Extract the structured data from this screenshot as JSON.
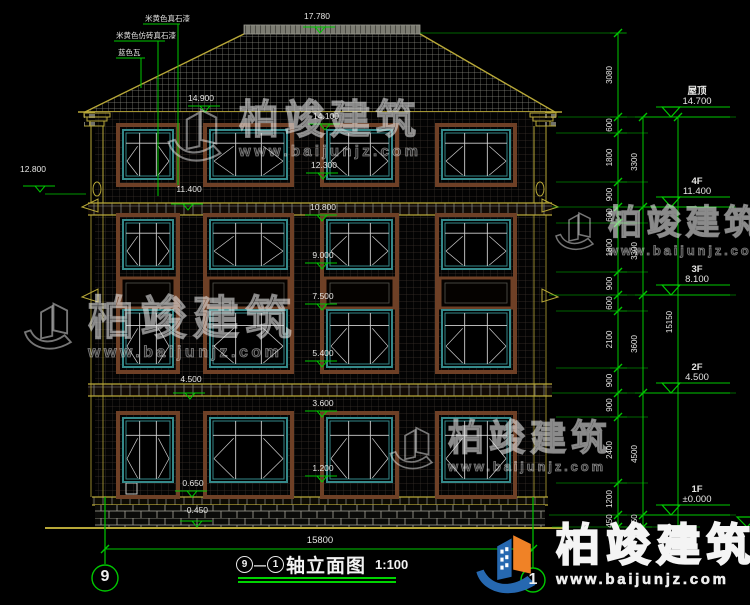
{
  "drawing": {
    "title": {
      "axis_a": "9",
      "dash": "—",
      "axis_b": "1",
      "name": "轴立面图",
      "scale": "1:100"
    },
    "bottom_overall_dim": "15800",
    "material_labels": [
      {
        "text": "米黄色真石漆",
        "x": 145,
        "y": 21,
        "ux": 180,
        "dx": 178,
        "dy": 185
      },
      {
        "text": "米黄色仿砖真石漆",
        "x": 116,
        "y": 38,
        "ux": 165,
        "dx": 158,
        "dy": 196
      },
      {
        "text": "蓝色瓦",
        "x": 118,
        "y": 55,
        "ux": 145,
        "dx": 141,
        "dy": 88
      }
    ],
    "elevation_marks": [
      {
        "value": "17.780",
        "x": 320,
        "y": 33,
        "tx": 317,
        "ty": 19
      },
      {
        "value": "14.900",
        "x": 205,
        "y": 112,
        "tx": 201,
        "ty": 101
      },
      {
        "value": "14.100",
        "x": 325,
        "y": 130,
        "tx": 326,
        "ty": 119
      },
      {
        "value": "12.300",
        "x": 323,
        "y": 179,
        "tx": 324,
        "ty": 168
      },
      {
        "value": "12.800",
        "x": 40,
        "y": 192,
        "tx": 33,
        "ty": 172
      },
      {
        "value": "11.400",
        "x": 188,
        "y": 210,
        "tx": 189,
        "ty": 192
      },
      {
        "value": "10.800",
        "x": 322,
        "y": 221,
        "tx": 323,
        "ty": 210
      },
      {
        "value": "9.000",
        "x": 322,
        "y": 269,
        "tx": 323,
        "ty": 258
      },
      {
        "value": "7.500",
        "x": 322,
        "y": 310,
        "tx": 323,
        "ty": 299
      },
      {
        "value": "5.400",
        "x": 322,
        "y": 367,
        "tx": 323,
        "ty": 356
      },
      {
        "value": "4.500",
        "x": 190,
        "y": 399,
        "tx": 191,
        "ty": 382
      },
      {
        "value": "3.600",
        "x": 322,
        "y": 417,
        "tx": 323,
        "ty": 406
      },
      {
        "value": "1.200",
        "x": 322,
        "y": 482,
        "tx": 323,
        "ty": 471
      },
      {
        "value": "0.650",
        "x": 192,
        "y": 497,
        "tx": 193,
        "ty": 486
      },
      {
        "value": "-0.450",
        "x": 197,
        "y": 527,
        "tx": 196,
        "ty": 513
      }
    ],
    "right_levels": [
      {
        "name": "屋顶",
        "value": "14.700",
        "y": 117
      },
      {
        "name": "4F",
        "value": "11.400",
        "y": 207
      },
      {
        "name": "3F",
        "value": "8.100",
        "y": 295
      },
      {
        "name": "2F",
        "value": "4.500",
        "y": 393
      },
      {
        "name": "1F",
        "value": "±0.000",
        "y": 515
      }
    ],
    "dim_chain_inner": {
      "x": 618,
      "ticks": [
        33,
        117,
        133,
        182,
        207,
        223,
        272,
        295,
        311,
        368,
        393,
        417,
        483,
        515,
        527
      ],
      "labels": [
        "3080",
        "600",
        "1800",
        "900",
        "600",
        "1800",
        "900",
        "600",
        "2100",
        "900",
        "900",
        "2400",
        "1200",
        "450"
      ]
    },
    "dim_chain_mid": {
      "x": 643,
      "ticks": [
        117,
        207,
        295,
        393,
        515,
        527
      ],
      "labels": [
        "3300",
        "3300",
        "3600",
        "4500",
        "450"
      ]
    },
    "dim_chain_outer": {
      "x": 678,
      "ticks": [
        117,
        527
      ],
      "labels": [
        "15150"
      ]
    }
  },
  "watermark": {
    "brand": "柏竣建筑",
    "url": "www.baijunjz.com"
  },
  "colors": {
    "background": "#000000",
    "annotation_green": "#00c800",
    "text_white": "#e6e6e4",
    "window_teal": "#35898a",
    "surround_brown": "#6e4026",
    "trim_yellow": "#b8a838",
    "roof_gray": "#88887e",
    "wall_grid": "#3a312b",
    "brick_mortar": "#a8a69a",
    "logo_blue": "#2668b0",
    "logo_orange": "#f08226"
  }
}
